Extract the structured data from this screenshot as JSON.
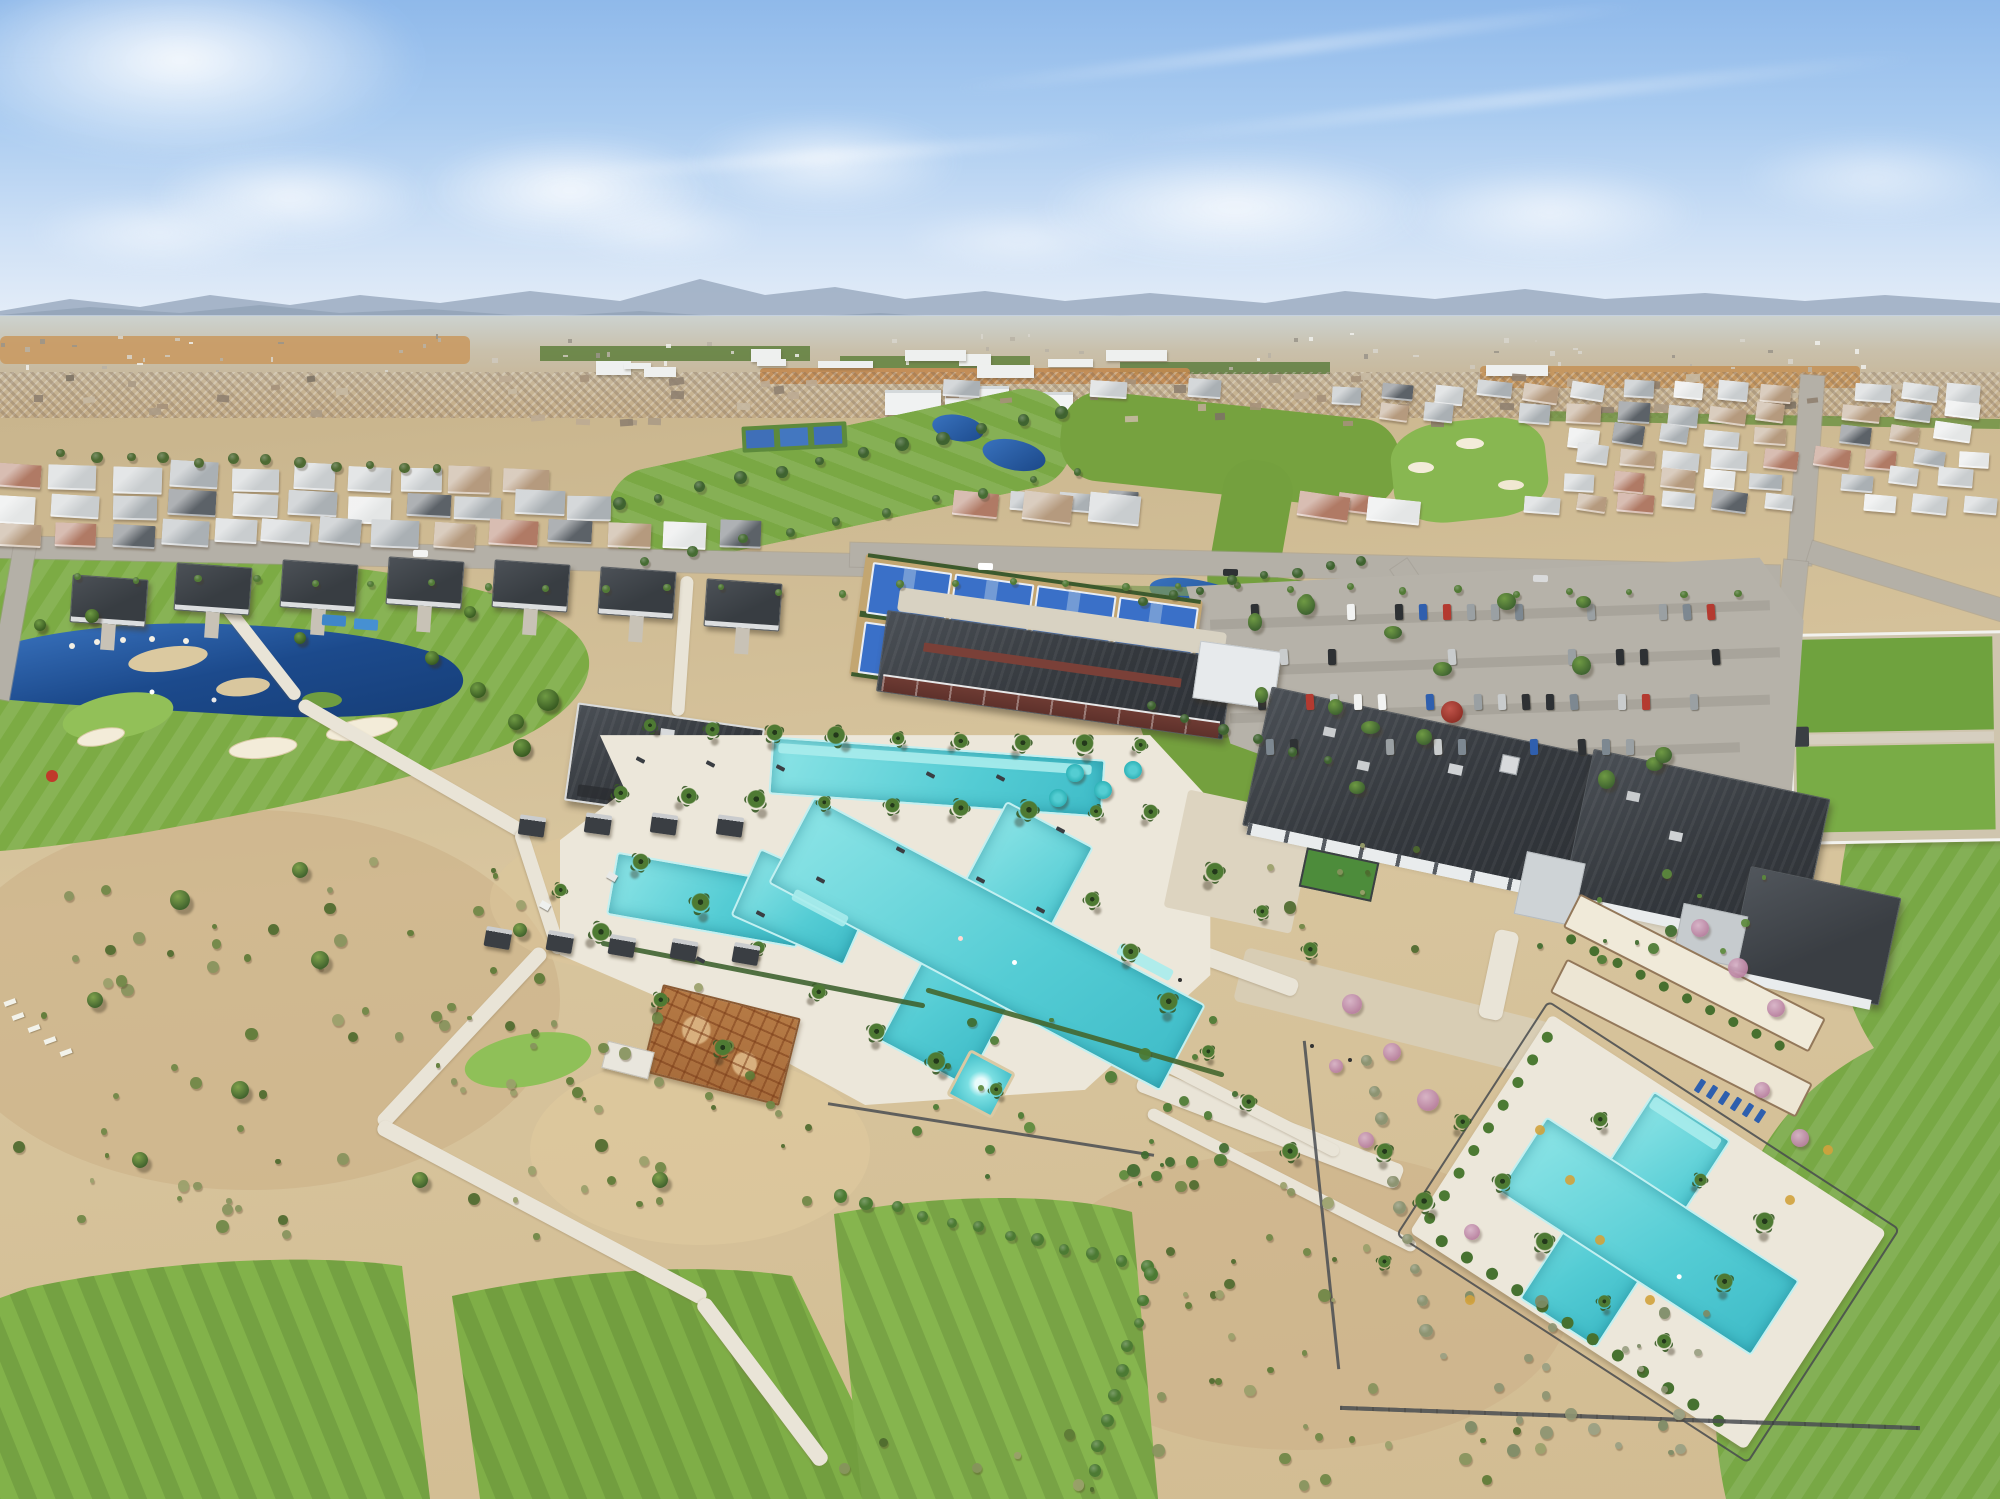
{
  "image": {
    "type": "aerial-drone-photograph",
    "subject": "master-planned desert community amenity campus with golf course, resort pools, clubhouse and sports courts",
    "sky": "clear blue with scattered cumulus and thin cirrus",
    "lighting": "midday sun",
    "horizon": "hazy mountain range behind distant city sprawl"
  },
  "features": {
    "pickleball_courts": 8,
    "bocce_courts": 2,
    "pools": [
      "resort cross-shaped pool",
      "upper wading pool",
      "spa",
      "second cross-shaped lap pool"
    ],
    "buildings": [
      "pool pavilion",
      "lap-pool barn with red siding",
      "clubhouse complex",
      "model homes row"
    ],
    "landscape": [
      "golf fairways",
      "blue lake with islands",
      "sand bunkers",
      "desert gravel gardens",
      "palm-lined pool decks",
      "event lawns with white fence",
      "community garden with rusted planters",
      "parking lot with cars"
    ]
  },
  "palette": {
    "sky_top": "#8fb9ea",
    "sky_horizon": "#e8eff8",
    "cloud": "#ffffff",
    "mountain_far": "#97a8bd",
    "mountain_near": "#8a9cb1",
    "distant_ground": "#c7b391",
    "dirt_orange": "#c28a50",
    "field_green": "#5f7f3c",
    "ground_tan": "#d0ba92",
    "gravel": "#c7ad85",
    "fairway": "#7cab44",
    "putting_green": "#92c058",
    "bunker": "#f3ecd9",
    "lake_deep": "#163e78",
    "lake_light": "#3a74c0",
    "pool": "#54ccd4",
    "pool_light": "#a9ecec",
    "deck": "#ece7da",
    "roof_dark": "#34383d",
    "roof_light": "#aab0b4",
    "wall_white": "#e9eced",
    "barn_red": "#6e3b33",
    "road": "#b4b0a7",
    "path": "#e9e4d7",
    "parking": "#b6b2a9",
    "court_blue": "#3a70c8",
    "court_apron": "#c3a671",
    "windscreen": "#3c5a2d",
    "shrub": "#5d7a36",
    "tree": "#3f6330",
    "sage": "#8d9472",
    "pink_tree": "#c49ab0",
    "rust": "#b57a45",
    "white_fence": "#f2f2ee",
    "car_colors": [
      "#f2f3f2",
      "#c9cccd",
      "#9aa0a3",
      "#2e3134",
      "#2f5fae",
      "#b43a30",
      "#7d8891"
    ],
    "roof_colors": [
      "#c9cdcf",
      "#aab0b4",
      "#e4e6e6",
      "#b59a7e",
      "#b07a65",
      "#5c6268"
    ],
    "umbrella_teal": "#2fb3b8",
    "lounger_blue": "#2e5fae"
  }
}
